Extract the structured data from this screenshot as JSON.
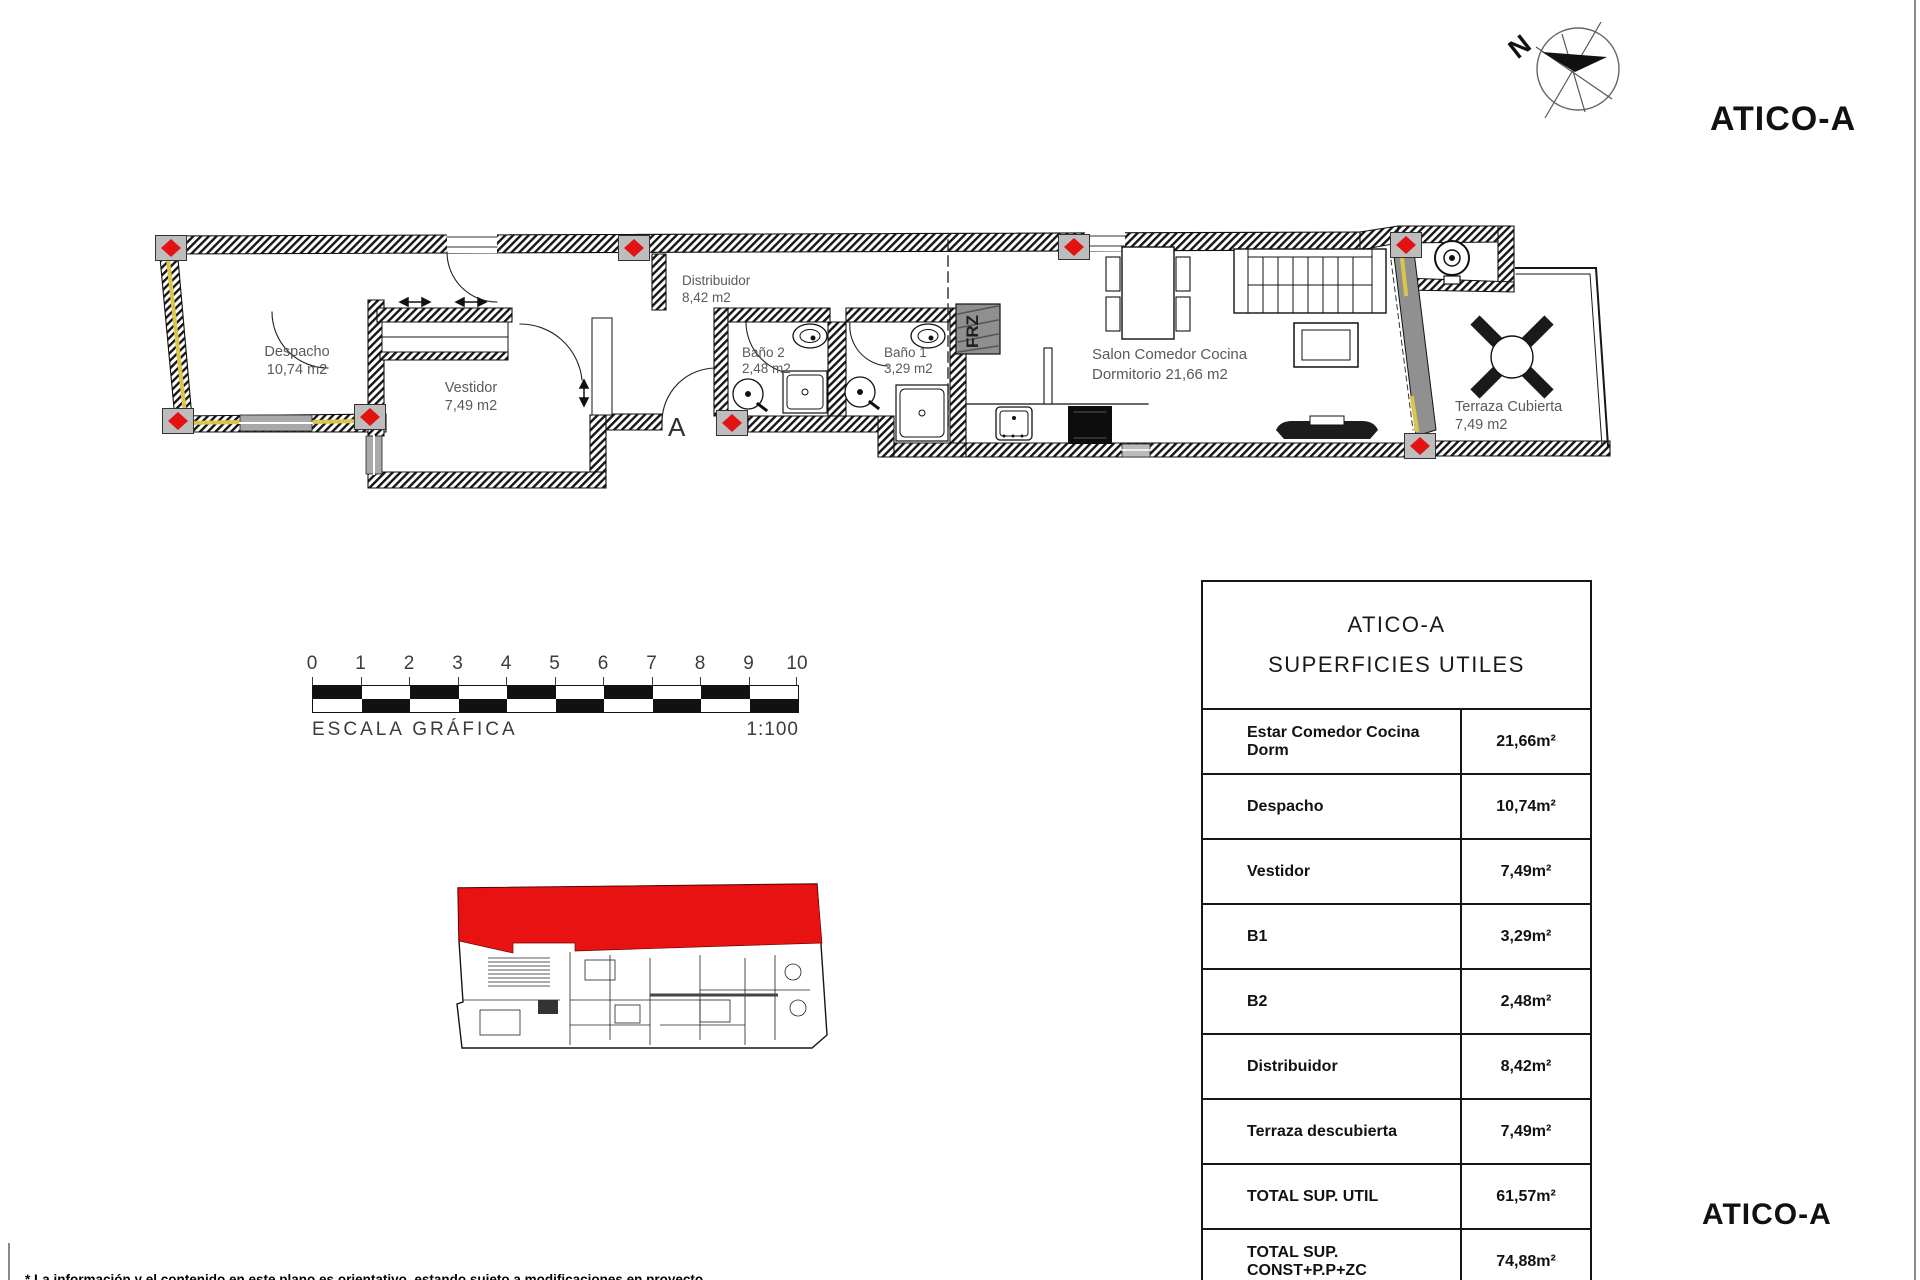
{
  "page": {
    "title_top": "ATICO-A",
    "title_bottom": "ATICO-A",
    "footnote": "* La información y el contenido en este plano es orientativo, estando sujeto a modificaciones en proyecto"
  },
  "north": {
    "label": "N"
  },
  "plan": {
    "labels": {
      "despacho": {
        "line1": "Despacho",
        "line2": "10,74 m2"
      },
      "vestidor": {
        "line1": "Vestidor",
        "line2": "7,49 m2"
      },
      "distribuidor": {
        "line1": "Distribuidor",
        "line2": "8,42 m2"
      },
      "bano2": {
        "line1": "Baño 2",
        "line2": "2,48 m2"
      },
      "bano1": {
        "line1": "Baño 1",
        "line2": "3,29 m2"
      },
      "salon": {
        "line1": "Salon Comedor Cocina",
        "line2": "Dormitorio  21,66 m2"
      },
      "terraza": {
        "line1": "Terraza Cubierta",
        "line2": "7,49 m2"
      }
    },
    "section_label": "A",
    "fridge_label": "FRZ"
  },
  "scale": {
    "ticks": [
      "0",
      "1",
      "2",
      "3",
      "4",
      "5",
      "6",
      "7",
      "8",
      "9",
      "10"
    ],
    "label": "ESCALA GRÁFICA",
    "ratio": "1:100"
  },
  "table": {
    "title_line1": "ATICO-A",
    "title_line2": "SUPERFICIES UTILES",
    "rows": [
      {
        "label": "Estar Comedor Cocina Dorm",
        "value": "21,66m²"
      },
      {
        "label": "Despacho",
        "value": "10,74m²"
      },
      {
        "label": "Vestidor",
        "value": "7,49m²"
      },
      {
        "label": "B1",
        "value": "3,29m²"
      },
      {
        "label": "B2",
        "value": "2,48m²"
      },
      {
        "label": "Distribuidor",
        "value": "8,42m²"
      },
      {
        "label": "Terraza descubierta",
        "value": "7,49m²"
      },
      {
        "label": "TOTAL SUP. UTIL",
        "value": "61,57m²"
      },
      {
        "label": "TOTAL SUP. CONST+P.P+ZC",
        "value": "74,88m²"
      }
    ]
  },
  "colors": {
    "accent_red": "#e31313",
    "wall_yellow": "#d9c64a",
    "unit_red": "#e81212"
  }
}
